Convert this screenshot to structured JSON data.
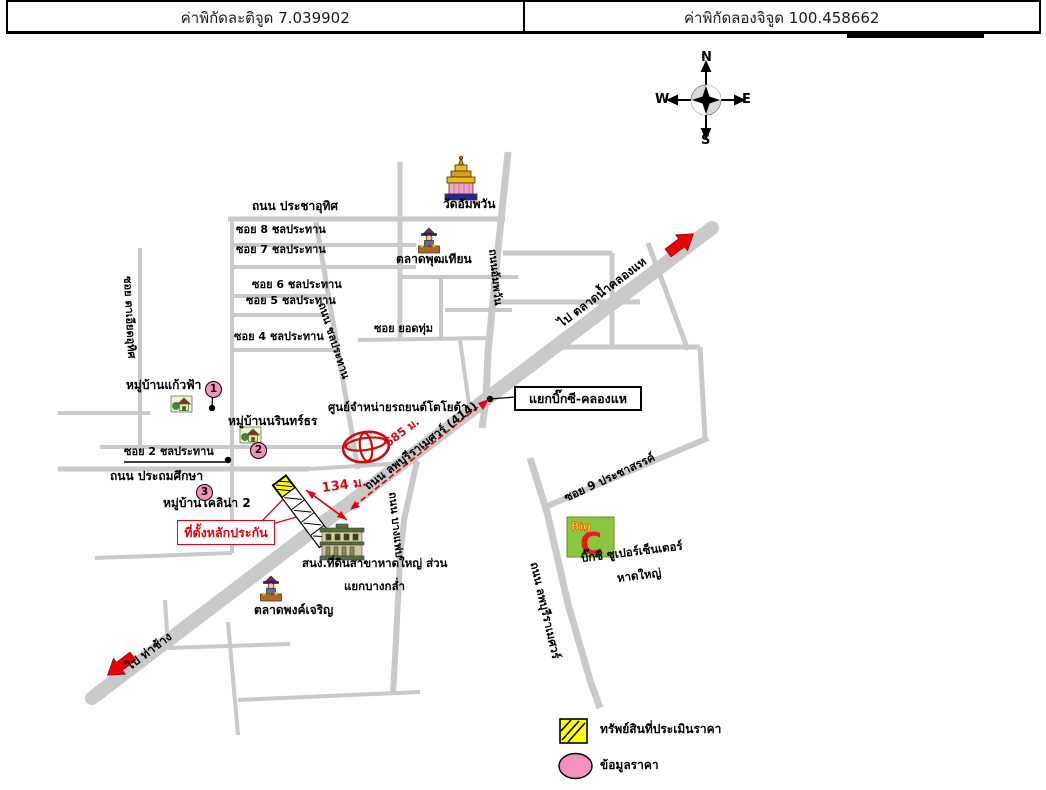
{
  "header": {
    "lat": "ค่าพิกัดละติจูด 7.039902",
    "lng": "ค่าพิกัดลองจิจูด 100.458662"
  },
  "compass": {
    "n": "N",
    "e": "E",
    "s": "S",
    "w": "W"
  },
  "roads": {
    "prachauthit": "ถนน ประชาอุทิศ",
    "soi8": "ซอย 8 ชลประทาน",
    "soi7": "ซอย 7 ชลประทาน",
    "soi6": "ซอย 6 ชลประทาน",
    "soi5": "ซอย 5 ชลประทาน",
    "soi4": "ซอย 4 ชลประทาน",
    "soi2": "ซอย 2 ชลประทาน",
    "prathomsuksa": "ถนน ประถมศึกษา",
    "taiat": "ซอย ตาเอียดอุทิศ",
    "chonprathan": "ถนน ชลประทาน",
    "yodthum": "ซอย ยอดทุ่ม",
    "ampawan": "ถนนอัมพวัน",
    "lopburi414": "ถนน ลพบุรีราเมศวร์ (414)",
    "lopburi": "ถนน ลพบุรีราเมศวร์",
    "bangfaep": "ถนน บางแฟบ",
    "soi9": "ซอย 9 ประชาสรรค์",
    "to_klonghae": "ไป ตลาดน้ำคลองแห",
    "to_thachang": "ไป ท่าช้าง"
  },
  "places": {
    "wat": "วัดอัมพวัน",
    "market_phut": "ตลาดพุฒเทียน",
    "kaewfa": "หมู่บ้านแก้วฟ้า",
    "narinthon": "หมู่บ้านนรินทร์ธร",
    "colina": "หมู่บ้านโคลิน่า 2",
    "toyota": "ศูนย์จำหน่ายรถยนต์โตโยต้า",
    "landoffice_line1": "สนง.ที่ดินสาขาหาดใหญ่ ส่วน",
    "landoffice_line2": "แยกบางกล่ำ",
    "market_pong": "ตลาดพงค์เจริญ",
    "bigc_line1": "บิ๊กซี ซูเปอร์เซ็นเตอร์",
    "bigc_line2": "หาดใหญ่",
    "bigc_logo_big": "Big",
    "bigc_logo_c": "C"
  },
  "annotations": {
    "collateral": "ที่ตั้งหลักประกัน",
    "junction": "แยกบิ๊กซี-คลองแห",
    "d685": "685 ม.",
    "d134": "134 ม.",
    "marker1": "1",
    "marker2": "2",
    "marker3": "3"
  },
  "legend": {
    "property": "ทรัพย์สินที่ประเมินราคา",
    "price": "ข้อมูลราคา"
  },
  "colors": {
    "road": "#c9c9c9",
    "accent_red": "#e8000d",
    "pink": "#f490bd",
    "hatch_yellow": "#ffff00",
    "bigc_green": "#8cc63e",
    "toyota_red": "#cc0b0b"
  }
}
